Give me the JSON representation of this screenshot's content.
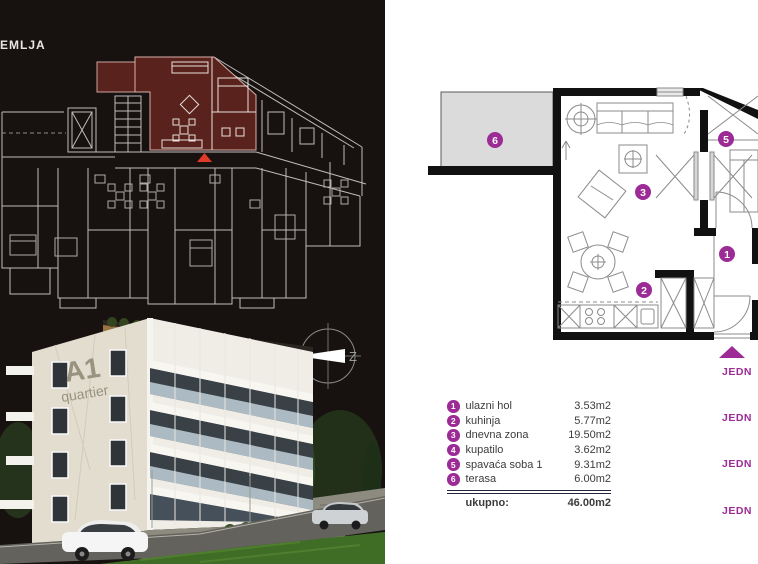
{
  "panel_left": {
    "floor_label": "EMLJA",
    "building": {
      "name": "A1",
      "subtitle": "quartier"
    },
    "compass": {
      "letter": "Z"
    }
  },
  "legend": {
    "items": [
      {
        "num": "1",
        "name": "ulazni hol",
        "area": "3.53m2"
      },
      {
        "num": "2",
        "name": "kuhinja",
        "area": "5.77m2"
      },
      {
        "num": "3",
        "name": "dnevna zona",
        "area": "19.50m2"
      },
      {
        "num": "4",
        "name": "kupatilo",
        "area": "3.62m2"
      },
      {
        "num": "5",
        "name": "spavaća soba 1",
        "area": "9.31m2"
      },
      {
        "num": "6",
        "name": "terasa",
        "area": "6.00m2"
      }
    ],
    "total_label": "ukupno:",
    "total_value": "46.00m2"
  },
  "side_labels": [
    "JEDN",
    "JEDN",
    "JEDN",
    "JEDN"
  ],
  "colors": {
    "accent": "#9c2b96",
    "highlight-red": "#5a221d",
    "marker-red": "#e03a28",
    "terrace-gray": "#dbdbdb",
    "wall-black": "#111111"
  }
}
